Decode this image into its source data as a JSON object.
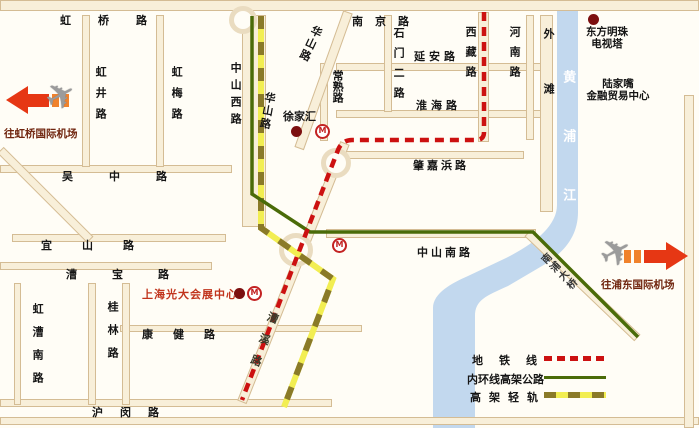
{
  "roads": {
    "hongqiao": "虹桥路",
    "nanjing": "南京路",
    "hongjing": "虹井路",
    "hongmei": "虹梅路",
    "zhongshan_xi": "中山西路",
    "huashan_upper": "华山路",
    "huashan_lower": "华山路",
    "changshu": "常熟路",
    "shimen_er": "石门二路",
    "yanan": "延安路",
    "huaihai": "淮海路",
    "xizang": "西藏路",
    "henan": "河南路",
    "waitan": "外滩",
    "wuzhong": "吴中路",
    "zhaojiabang": "肇嘉浜路",
    "yishan": "宜山路",
    "zhongshan_nan": "中山南路",
    "caobao": "漕宝路",
    "kangjian": "康健路",
    "caoxi": "漕溪路",
    "humin": "沪闵路",
    "hongcao_nan": "虹漕南路",
    "guilin": "桂林路",
    "nanpu_bridge": "南浦大桥"
  },
  "river": {
    "name": "黄浦江"
  },
  "landmarks": {
    "xujiahui": "徐家汇",
    "oriental_pearl_line1": "东方明珠",
    "oriental_pearl_line2": "电视塔",
    "lujiazui_line1": "陆家嘴",
    "lujiazui_line2": "金融贸易中心",
    "everbright": "上海光大会展中心"
  },
  "airports": {
    "hongqiao": "往虹桥国际机场",
    "pudong": "往浦东国际机场"
  },
  "legend": {
    "items": [
      {
        "label": "地铁线",
        "style": "red-dashed-line",
        "color": "#cc1111"
      },
      {
        "label": "内环线高架公路",
        "style": "green-solid-line",
        "color": "#4a6b08"
      },
      {
        "label": "高架轻轨",
        "style": "yellow-olive-dashed-line",
        "color": "#f2ee52"
      }
    ]
  },
  "icons": {
    "metro_logo": "M",
    "airplane": "✈"
  }
}
